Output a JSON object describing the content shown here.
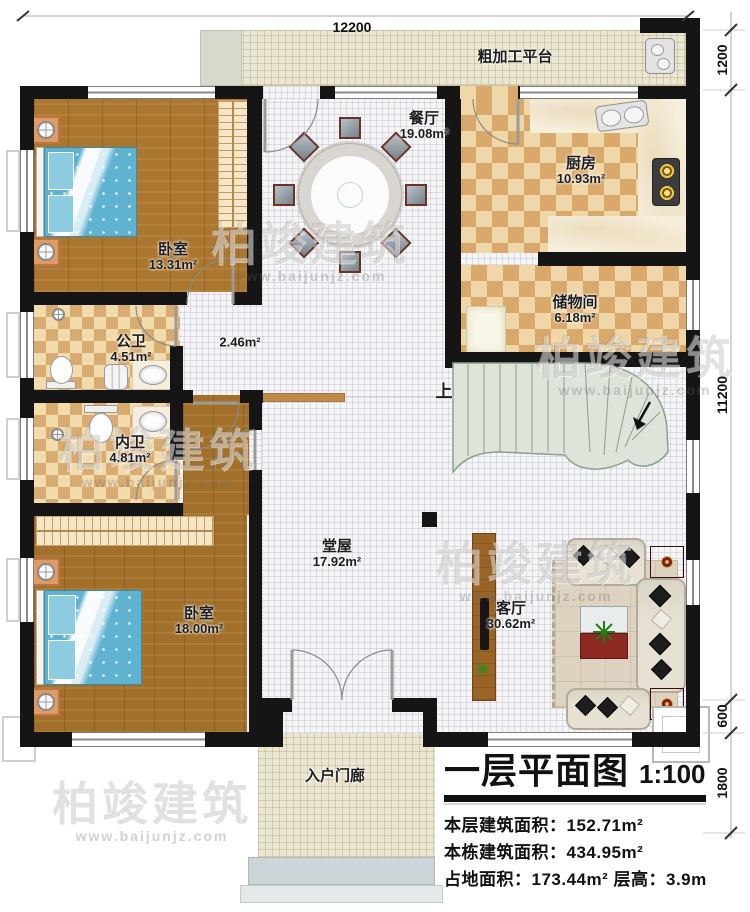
{
  "dimensions": {
    "top": "12200",
    "right": [
      "1200",
      "11200",
      "600",
      "1800"
    ]
  },
  "rooms": [
    {
      "name": "粗加工平台",
      "area": ""
    },
    {
      "name": "卧室",
      "area": "13.31m²"
    },
    {
      "name": "餐厅",
      "area": "19.08m²"
    },
    {
      "name": "厨房",
      "area": "10.93m²"
    },
    {
      "name": "公卫",
      "area": "4.51m²"
    },
    {
      "name": "",
      "area": "2.46m²"
    },
    {
      "name": "储物间",
      "area": "6.18m²"
    },
    {
      "name": "内卫",
      "area": "4.81m²"
    },
    {
      "name": "卧室",
      "area": "18.00m²"
    },
    {
      "name": "堂屋",
      "area": "17.92m²"
    },
    {
      "name": "客厅",
      "area": "30.62m²"
    },
    {
      "name": "入户门廊",
      "area": ""
    }
  ],
  "stair": {
    "up": "上"
  },
  "watermark": {
    "brand": "柏竣建筑",
    "url": "www.baijunjz.com"
  },
  "title_block": {
    "title": "一层平面图",
    "scale": "1:100",
    "lines": [
      "本层建筑面积：152.71m²",
      "本栋建筑面积：434.95m²",
      "占地面积：173.44m² 层高：3.9m"
    ]
  }
}
